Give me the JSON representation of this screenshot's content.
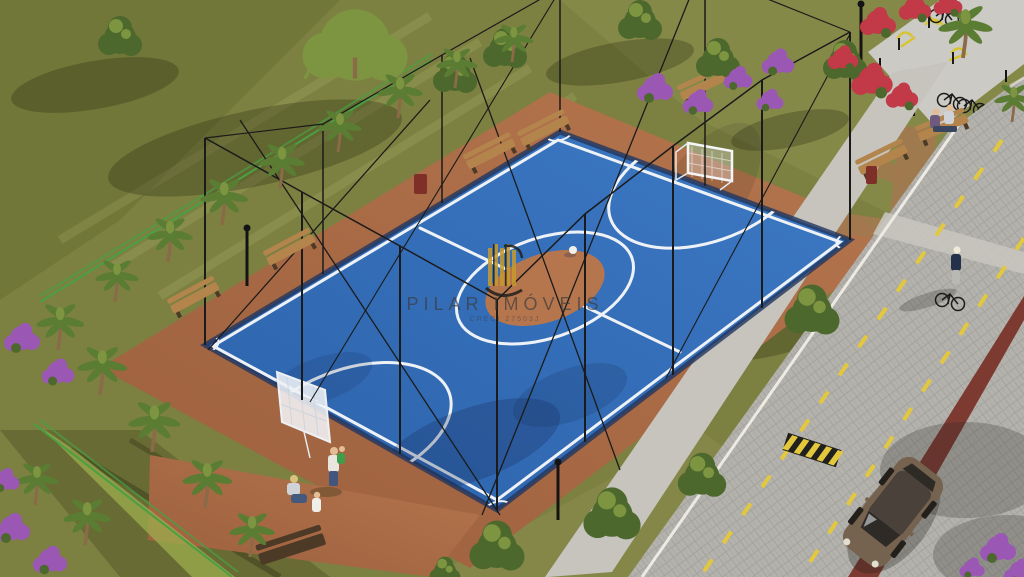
{
  "watermark": {
    "title": "PILAR IMÓVEIS",
    "subtitle": "CRECI 27503J",
    "logo_icon": "gold-striped-building-logo"
  },
  "scene": {
    "type": "architectural-aerial-rendering",
    "main_subject": "blue-futsal-court-with-black-net-enclosure",
    "objects": [
      "futsal-court",
      "white-court-markings",
      "center-circle",
      "goal-top",
      "goal-bottom",
      "soccer-ball",
      "terracotta-walkway",
      "wooden-benches",
      "trash-bins",
      "lamp-posts",
      "palm-trees",
      "willow-tree",
      "round-trees",
      "purple-bougainvillea",
      "red-bougainvillea",
      "green-perimeter-fence",
      "outdoor-gym-plaza",
      "yellow-exercise-equipment",
      "bicycle-racks",
      "cobblestone-road",
      "yellow-lane-dashes",
      "sidewalk",
      "crosswalk",
      "hatched-road-marker",
      "brown-hatchback-car",
      "cyclist-walking-bike",
      "family-near-court",
      "couple-on-bench"
    ]
  },
  "colors": {
    "grass": "#7c8040",
    "grass_light": "#8e9150",
    "grass_dark": "#5f652f",
    "court_blue": "#2c62ab",
    "court_blue_light": "#3d79c4",
    "court_line": "#eef2f6",
    "terracotta": "#9c5f3d",
    "terracotta_light": "#b5764e",
    "dirt_path": "#a2794f",
    "road": "#b4b2ac",
    "sidewalk": "#c6c4bd",
    "curb": "#eceae2",
    "plaza": "#cbcac4",
    "lane_yellow": "#e3c83d",
    "maroon_strip": "#7c3a30",
    "fence_green": "#49a043",
    "hedge_green": "#9cae4e",
    "net_black": "#1b1b1b",
    "tree_green": "#4d682d",
    "tree_green_light": "#7d9440",
    "palm_green": "#5b7c33",
    "trunk_brown": "#8a6a48",
    "bougainvillea_purple": "#9a58b4",
    "bougainvillea_red": "#c23947",
    "bench_wood": "#b3854d",
    "bench_dark": "#4c3a27",
    "bin_red": "#7e2f28",
    "car_body": "#75634f",
    "car_glass": "#2e2a26",
    "equipment_yellow": "#d8c430",
    "skin": "#e2bd96",
    "logo_gold": "#c79a2d",
    "text_dark": "#3d3d3d"
  }
}
